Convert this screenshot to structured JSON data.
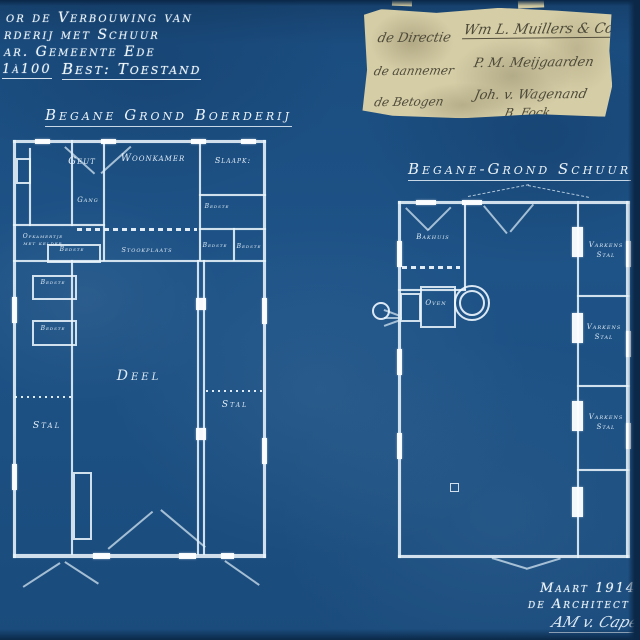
{
  "palette": {
    "background": "#1b4d7f",
    "line": "#e9f4fb",
    "paper": "#d5cda6",
    "ink": "#4e4a3a"
  },
  "header": {
    "line1": "or de Verbouwing van",
    "line2": "rderij met Schuur",
    "line3": "ar. Gemeente Ede",
    "scale": "1à100",
    "line4": "Best: Toestand"
  },
  "stamp": {
    "rows": [
      {
        "left": "de Directie",
        "right": "Wm L. Muillers & Co"
      },
      {
        "left": "de aannemer",
        "right": "P. M. Meijgaarden"
      },
      {
        "left": "de Betogen",
        "right": "Joh. v. Wagenand"
      },
      {
        "left": "",
        "right": "B. Fock"
      }
    ]
  },
  "plan1": {
    "title": "Begane Grond Boerderij",
    "rooms": {
      "geut": "Geut",
      "gang": "Gang",
      "woonkamer": "Woonkamer",
      "slaapk": "Slaapk:",
      "bedste_r1": "Bedste",
      "bedste_r2": "Bedste",
      "bedste_r3": "Bedste",
      "opkamertje_1": "Opkamertje",
      "opkamertje_2": "met kelder",
      "bedste_l": "Bedste",
      "stookplaats": "Stookplaats",
      "bedste_m1": "Bedste",
      "bedste_m2": "Bedste",
      "deel": "Deel",
      "stal_left": "Stal",
      "stal_right": "Stal"
    }
  },
  "plan2": {
    "title": "Begane-Grond Schuur",
    "rooms": {
      "bakhuis": "Bakhuis",
      "oven": "Oven",
      "varkens1a": "Varkens",
      "varkens1b": "Stal",
      "varkens2a": "Varkens",
      "varkens2b": "Stal",
      "varkens3a": "Varkens",
      "varkens3b": "Stal"
    }
  },
  "footer": {
    "date": "Maart 1914",
    "role": "de Architect",
    "signature": "AM v. Capel"
  }
}
